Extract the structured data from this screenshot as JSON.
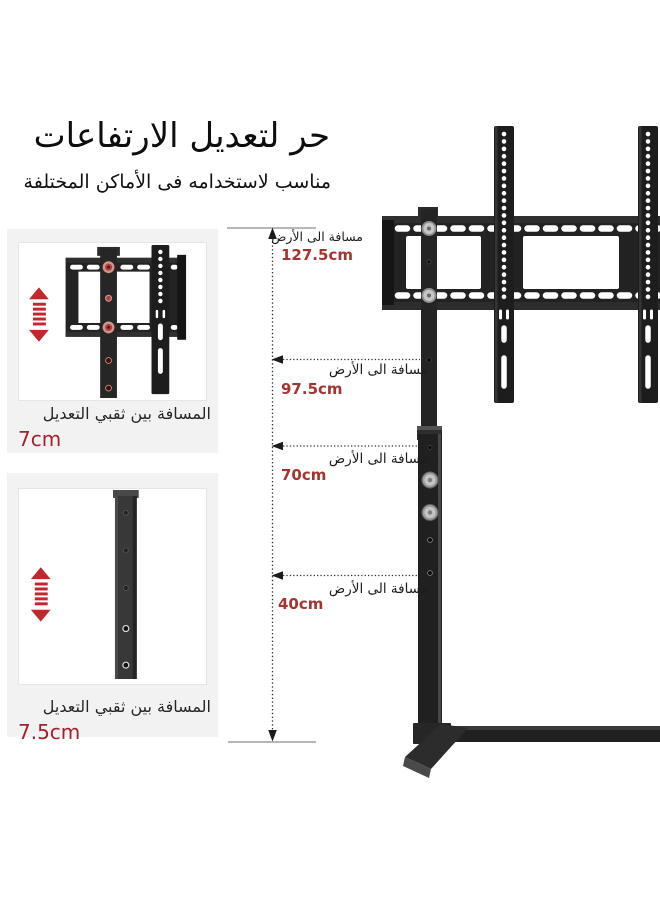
{
  "header": {
    "title": "حر لتعديل الارتفاعات",
    "subtitle": "مناسب لاستخدامه فى الأماكن المختلفة"
  },
  "insets": [
    {
      "caption": "المسافة بين ثقبي التعديل",
      "value": "7cm"
    },
    {
      "caption": "المسافة بين ثقبي التعديل",
      "value": "7.5cm"
    }
  ],
  "measurements": [
    {
      "label": "مسافة الى الأرض",
      "value": "127.5cm"
    },
    {
      "label": "مسافة الى الأرض",
      "value": "97.5cm"
    },
    {
      "label": "مسافة الى الأرض",
      "value": "70cm"
    },
    {
      "label": "مسافة الى الأرض",
      "value": "40cm"
    }
  ],
  "icons": {
    "adjust_up_down": "up-down-arrow-icon"
  },
  "colors": {
    "accent_red": "#c1272d",
    "value_red": "#a23530",
    "inset_value_red": "#a6212e",
    "text_dark": "#0d0d0d",
    "inset_bg": "#f2f2f2",
    "metal_dark": "#1d1d1d"
  }
}
